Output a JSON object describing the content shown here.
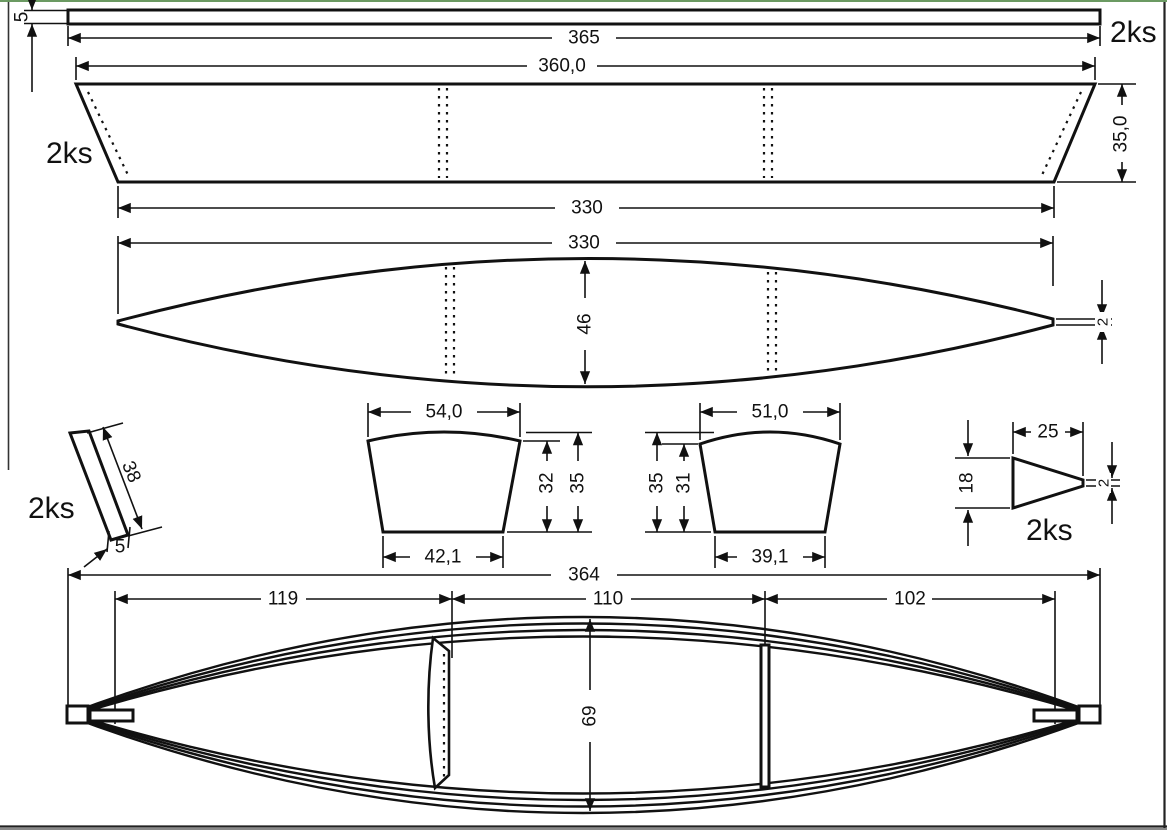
{
  "drawing": {
    "parts": {
      "rail": {
        "qty": "2ks",
        "length": "365",
        "thickness": "5"
      },
      "side_panel": {
        "qty": "2ks",
        "top_width": "360,0",
        "height": "35,0",
        "bottom_width": "330"
      },
      "bottom_panel": {
        "length": "330",
        "max_width": "46",
        "tip_width": "2"
      },
      "stem_strip": {
        "qty": "2ks",
        "length": "38",
        "width": "5"
      },
      "frame_bow": {
        "top_width": "54,0",
        "bottom_width": "42,1",
        "side_height": "32",
        "total_height": "35"
      },
      "frame_stern": {
        "top_width": "51,0",
        "bottom_width": "39,1",
        "side_height": "31",
        "total_height": "35"
      },
      "stem_wedge": {
        "qty": "2ks",
        "width": "25",
        "height": "18",
        "tip_width": "2"
      },
      "assembly": {
        "overall_length": "364",
        "bow_section": "119",
        "mid_section": "110",
        "stern_section": "102",
        "beam_width": "69"
      }
    },
    "colors": {
      "line": "#111111",
      "background": "#ffffff",
      "top_edge": "#6b9a62",
      "frame_border": "#222222"
    }
  }
}
